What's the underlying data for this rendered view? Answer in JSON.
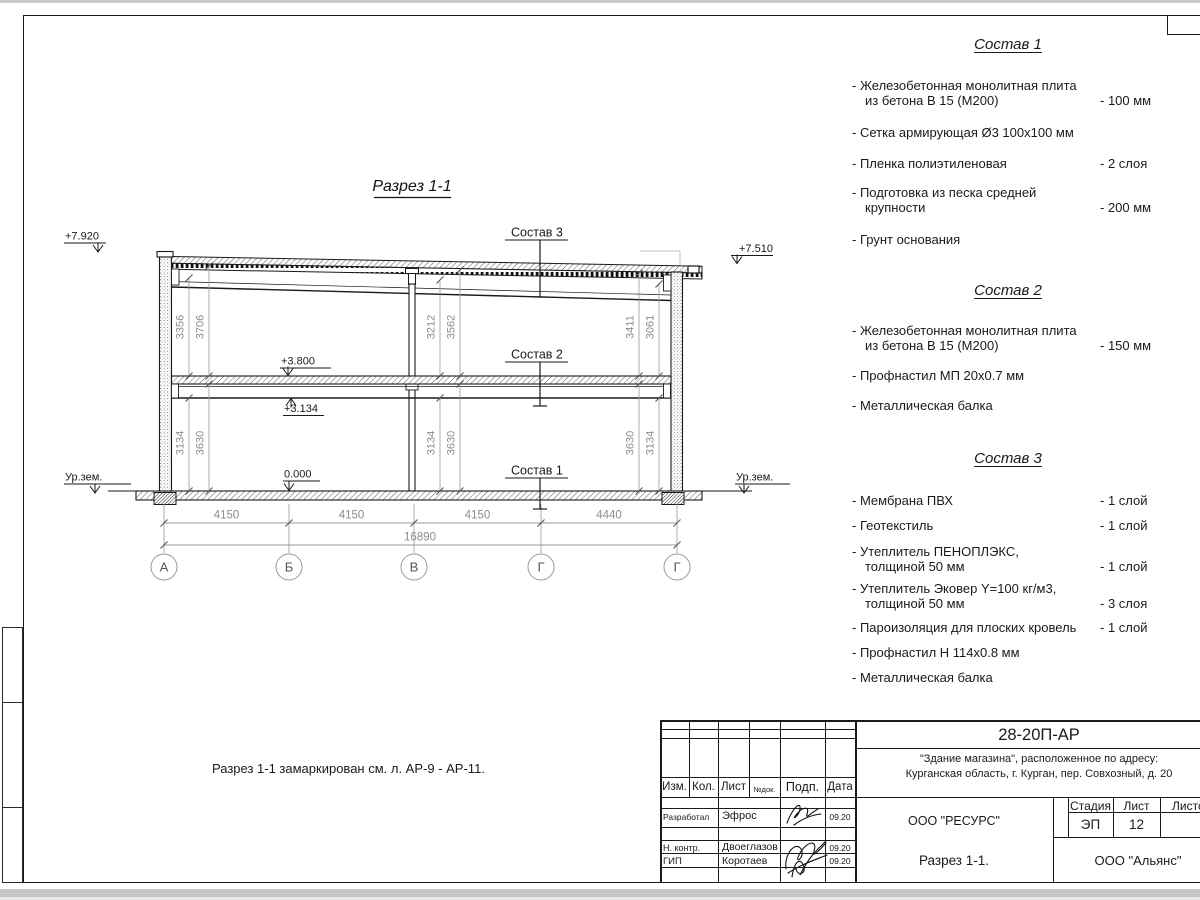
{
  "drawing": {
    "title": "Разрез 1-1",
    "note": "Разрез 1-1 замаркирован см. л. АР-9 - АР-11.",
    "levels": {
      "roof_left": "+7.920",
      "roof_right": "+7.510",
      "floor2": "+3.800",
      "beam": "+3.134",
      "zero": "0.000",
      "ground_left": "Ур.зем.",
      "ground_right": "Ур.зем."
    },
    "callouts": {
      "s1": "Состав 1",
      "s2": "Состав 2",
      "s3": "Состав 3"
    },
    "vdims": {
      "a_up_in": "3356",
      "a_up_out": "3706",
      "b_up_in": "3212",
      "b_up_out": "3562",
      "g_up_in": "3411",
      "g_up_out": "3061",
      "a_lo_in": "3134",
      "a_lo_out": "3630",
      "b_lo_in": "3134",
      "b_lo_out": "3630",
      "g_lo_in": "3630",
      "g_lo_out": "3134"
    },
    "hdims": [
      "4150",
      "4150",
      "4150",
      "4440"
    ],
    "total_dim": "16890",
    "axes": [
      "А",
      "Б",
      "В",
      "Г",
      "Г"
    ]
  },
  "compositions": [
    {
      "title": "Состав 1",
      "items": [
        {
          "t1": "- Железобетонная  монолитная плита",
          "t2": "из бетона В 15 (М200)",
          "v": "- 100 мм"
        },
        {
          "t1": "- Сетка армирующая Ø3 100х100 мм"
        },
        {
          "t1": "- Пленка полиэтиленовая",
          "v": "-  2 слоя"
        },
        {
          "t1": "- Подготовка из песка средней",
          "t2": "крупности",
          "v": "- 200 мм"
        },
        {
          "t1": "- Грунт основания"
        }
      ]
    },
    {
      "title": "Состав 2",
      "items": [
        {
          "t1": "- Железобетонная  монолитная плита",
          "t2": "из бетона В 15 (М200)",
          "v": "- 150 мм"
        },
        {
          "t1": "- Профнастил МП 20х0.7 мм"
        },
        {
          "t1": "- Металлическая балка"
        }
      ]
    },
    {
      "title": "Состав 3",
      "items": [
        {
          "t1": "- Мембрана ПВХ",
          "v": "- 1 слой"
        },
        {
          "t1": "- Геотекстиль",
          "v": "- 1 слой"
        },
        {
          "t1": "- Утеплитель ПЕНОПЛЭКС,",
          "t2": "толщиной 50 мм",
          "v": "- 1 слой"
        },
        {
          "t1": "- Утеплитель Эковер Y=100 кг/м3,",
          "t2": "толщиной 50 мм",
          "v": "- 3 слоя"
        },
        {
          "t1": "- Пароизоляция для плоских кровель",
          "v": "- 1 слой"
        },
        {
          "t1": "- Профнастил Н 114х0.8 мм"
        },
        {
          "t1": "- Металлическая балка"
        }
      ]
    }
  ],
  "titleblock": {
    "doc_number": "28-20П-АР",
    "object_line1": "\"Здание магазина\", расположенное по адресу:",
    "object_line2": "Курганская область, г. Курган, пер. Совхозный, д. 20",
    "org": "ООО \"РЕСУРС\"",
    "sheet_title": "Разрез 1-1.",
    "contractor": "ООО \"Альянс\"",
    "cols": {
      "izm": "Изм.",
      "kol": "Кол.",
      "list": "Лист",
      "ndoc": "№док.",
      "podp": "Подп.",
      "data": "Дата"
    },
    "stage_label": "Стадия",
    "sheet_label": "Лист",
    "sheets_label": "Листов",
    "stage": "ЭП",
    "sheet_no": "12",
    "rows": [
      {
        "role": "Разработал",
        "name": "Эфрос",
        "date": "09.20"
      },
      {
        "role": "Н. контр.",
        "name": "Двоеглазов",
        "date": "09.20"
      },
      {
        "role": "ГИП",
        "name": "Коротаев",
        "date": "09.20"
      }
    ]
  }
}
